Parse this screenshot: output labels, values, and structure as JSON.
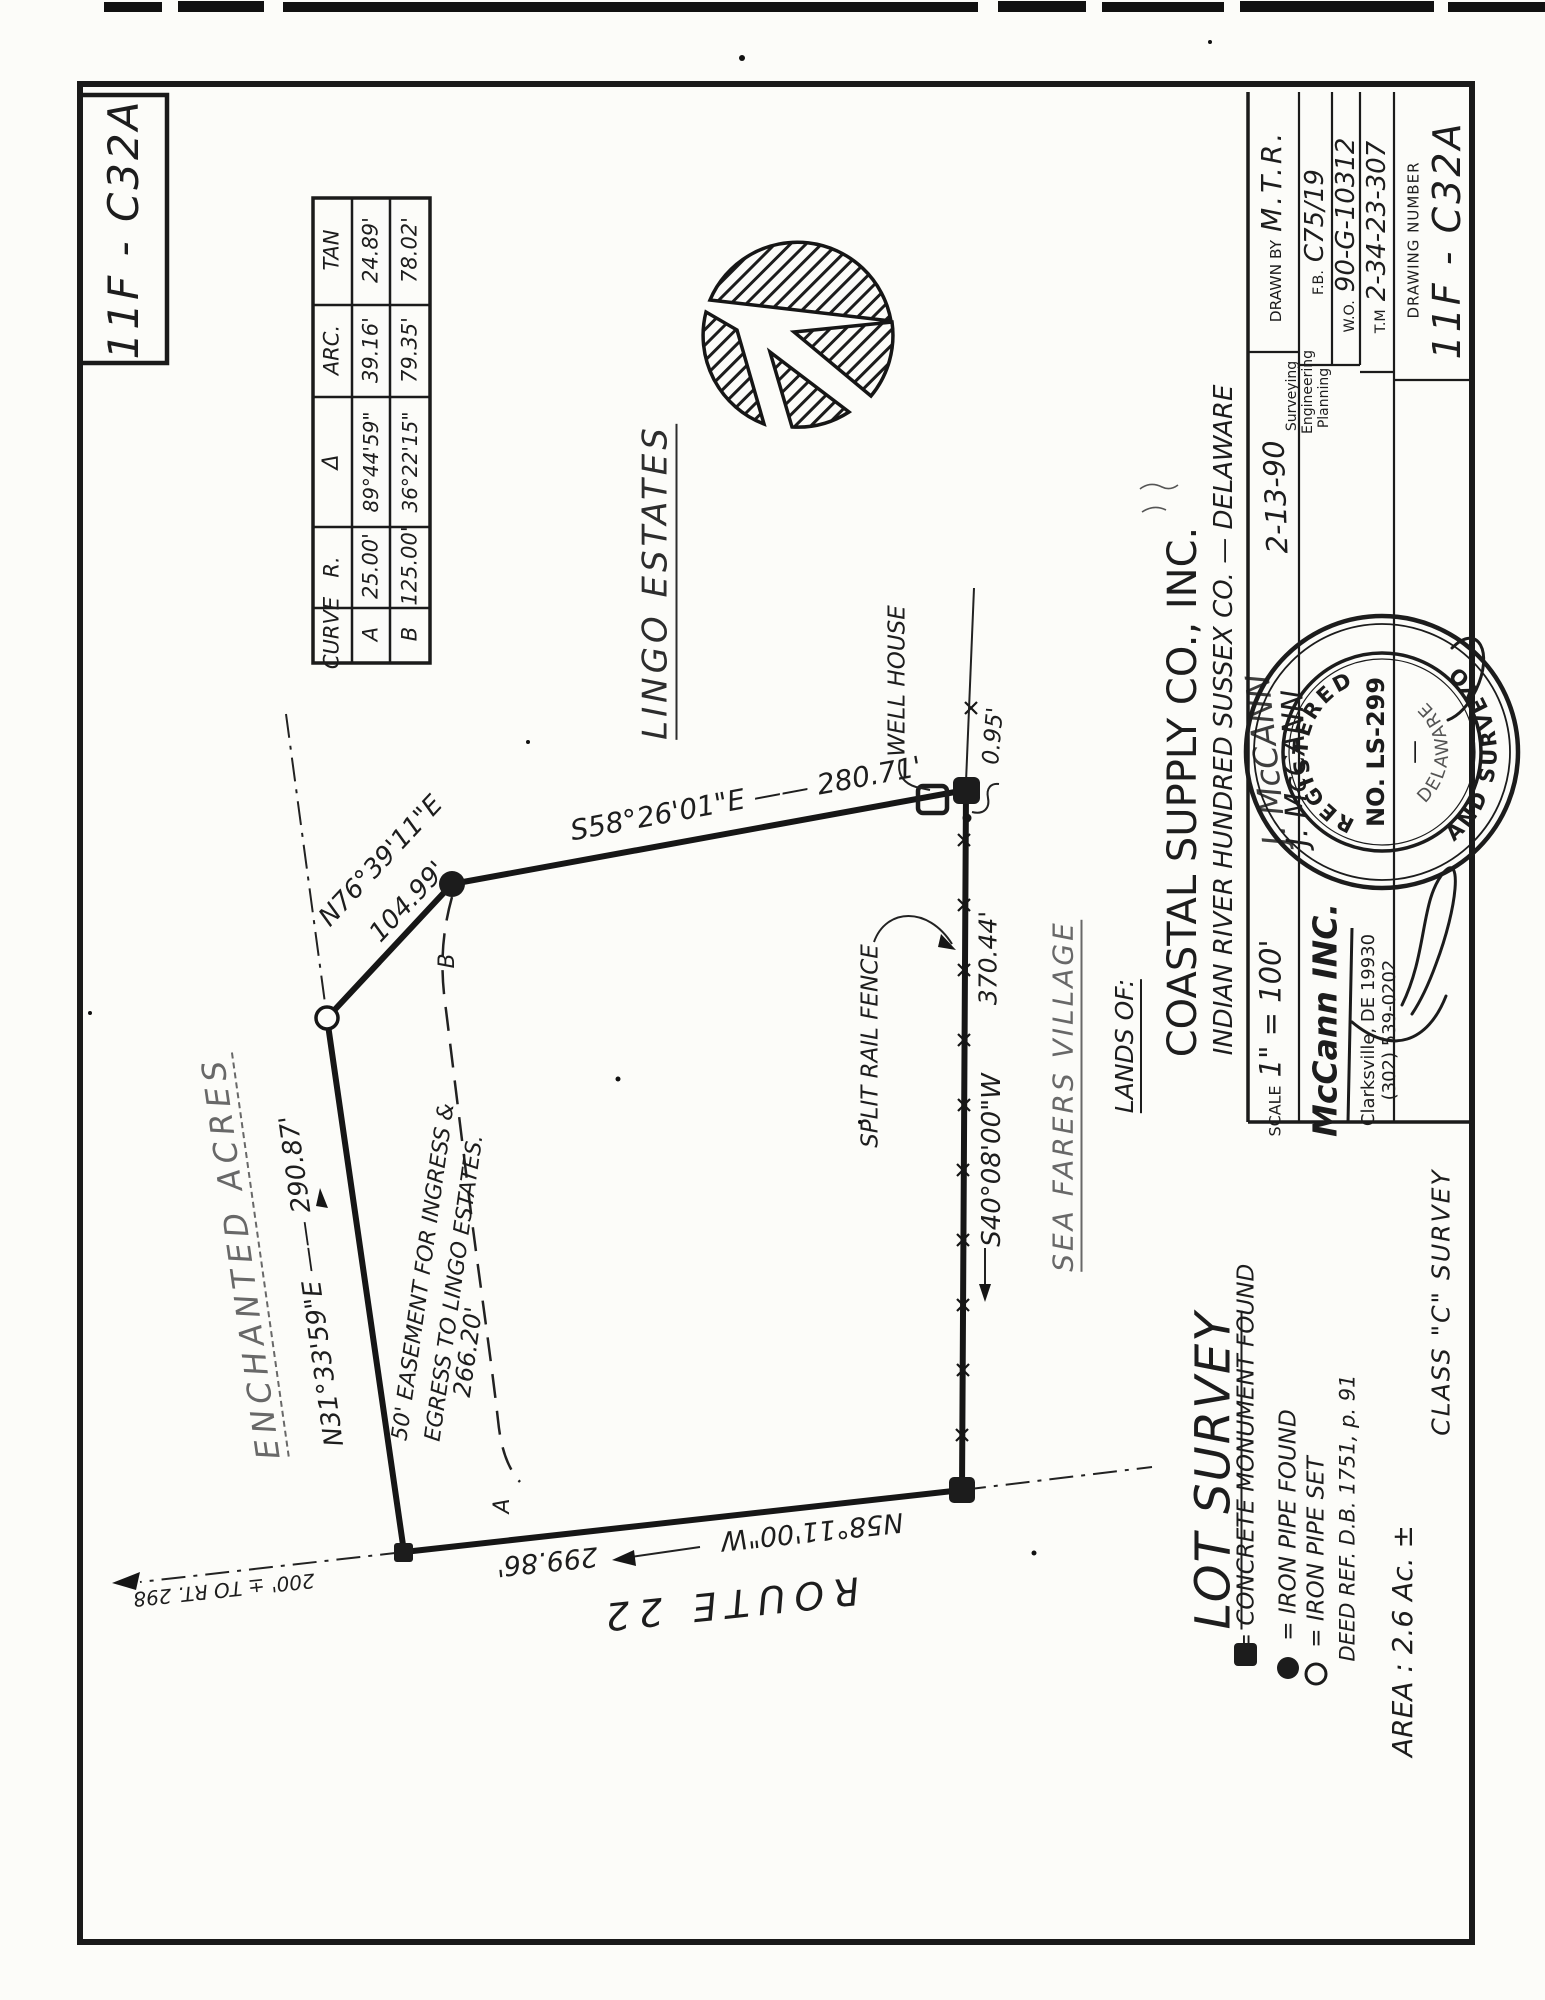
{
  "sheet": {
    "corner_label": "11F - C32A"
  },
  "curve_table": {
    "headers": {
      "curve": "CURVE",
      "r": "R.",
      "delta": "Δ",
      "arc": "ARC.",
      "tan": "TAN"
    },
    "rows": [
      {
        "id": "A",
        "r": "25.00'",
        "delta": "89°44'59\"",
        "arc": "39.16'",
        "tan": "24.89'"
      },
      {
        "id": "B",
        "r": "125.00'",
        "delta": "36°22'15\"",
        "arc": "79.35'",
        "tan": "78.02'"
      }
    ]
  },
  "adjoiners": {
    "lingo": "LINGO ESTATES",
    "enchanted": "ENCHANTED ACRES",
    "seafarers": "SEA FARERS VILLAGE",
    "route22": "ROUTE 22",
    "route_ref": "200' ± TO RT. 298"
  },
  "boundaries": {
    "north": {
      "label": "N76°39'11\"E",
      "distance": "104.99'"
    },
    "northeast": {
      "label": "S58°26'01\"E  ——  280.71'"
    },
    "east": {
      "label": "S40°08'00\"W",
      "distance": "370.44'"
    },
    "south": {
      "label": "N58°11'00\"W",
      "distance": "299.86'"
    },
    "west": {
      "label": "N31°33'59\"E  ——  290.87'"
    }
  },
  "features": {
    "well_house": "WELL HOUSE",
    "fence": "SPLIT RAIL FENCE",
    "fence_offset": "0.95'",
    "easement_line1": "50' EASEMENT FOR INGRESS &",
    "easement_line2": "EGRESS TO LINGO ESTATES.",
    "easement_length": "266.20'",
    "curve_a": "A",
    "curve_b": "B"
  },
  "legend": {
    "title": "LOT SURVEY",
    "monument": "= CONCRETE MONUMENT FOUND",
    "pipe_found": "= IRON PIPE FOUND",
    "pipe_set": "= IRON PIPE SET",
    "deed_ref": "DEED REF. D.B. 1751, p. 91",
    "area": "AREA :  2.6 Ac. ±",
    "survey_class": "CLASS  \"C\"  SURVEY"
  },
  "title_block": {
    "lands_of": "LANDS OF:",
    "company": "COASTAL SUPPLY CO., INC.",
    "location": "INDIAN RIVER HUNDRED    SUSSEX CO.  —  DELAWARE",
    "scale_label": "SCALE",
    "scale_value": "1\" = 100'",
    "date": "2-13-90",
    "signature": "J. McCANN",
    "firm": "McCann INC.",
    "addr1": "Clarksville, DE 19930",
    "addr2": "(302) 539-0202",
    "svc1": "Surveying",
    "svc2": "Engineering",
    "svc3": "Planning",
    "drawn_by_label": "DRAWN BY",
    "drawn_by": "M.T.R.",
    "fb_label": "F.B.",
    "fb": "C75/19",
    "wo_label": "W.O.",
    "wo": "90-G-10312",
    "tm_label": "T.M",
    "tm": "2-34-23-307",
    "drawing_number_label": "DRAWING NUMBER",
    "drawing_number": "11F - C32A"
  },
  "seal": {
    "registered": "REGISTERED",
    "number": "NO. LS-299",
    "state": "DELAWARE",
    "title": "LAND SURVEYOR",
    "dash": "—"
  }
}
